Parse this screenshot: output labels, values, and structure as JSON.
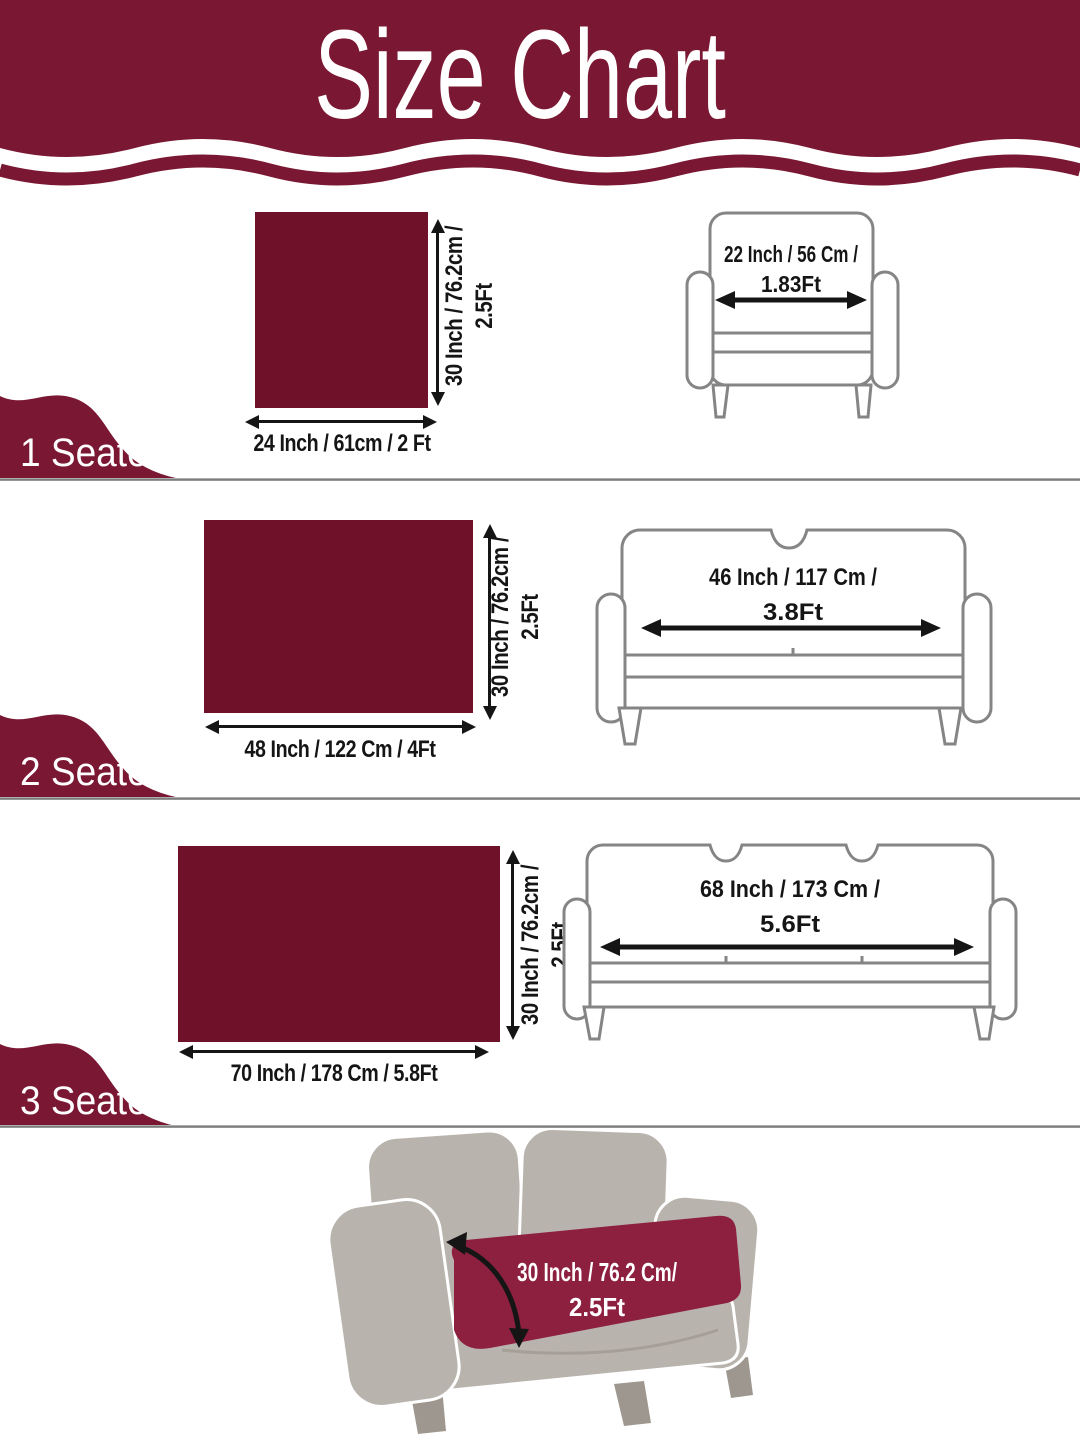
{
  "title": "Size Chart",
  "colors": {
    "header_maroon": "#7a1732",
    "swatch_maroon": "#6f1129",
    "cover_maroon": "#8d1f3f",
    "sofa_gray": "#b9b3ad",
    "sketch_gray": "#858585",
    "arrow_black": "#151515"
  },
  "sections": [
    {
      "label": "1 Seater",
      "cover_width_label": "24 Inch / 61cm / 2 Ft",
      "cover_height_label_line1": "30 Inch / 76.2cm /",
      "cover_height_label_line2": "2.5Ft",
      "sofa_width_label_line1": "22 Inch / 56 Cm /",
      "sofa_width_label_line2": "1.83Ft"
    },
    {
      "label": "2 Seater",
      "cover_width_label": "48 Inch / 122 Cm / 4Ft",
      "cover_height_label_line1": "30 Inch / 76.2cm /",
      "cover_height_label_line2": "2.5Ft",
      "sofa_width_label_line1": "46 Inch / 117 Cm /",
      "sofa_width_label_line2": "3.8Ft"
    },
    {
      "label": "3 Seater",
      "cover_width_label": "70 Inch / 178 Cm / 5.8Ft",
      "cover_height_label_line1": "30 Inch / 76.2cm /",
      "cover_height_label_line2": "2.5Ft",
      "sofa_width_label_line1": "68 Inch / 173 Cm /",
      "sofa_width_label_line2": "5.6Ft"
    }
  ],
  "footer": {
    "depth_label_line1": "30 Inch / 76.2 Cm/",
    "depth_label_line2": "2.5Ft"
  }
}
